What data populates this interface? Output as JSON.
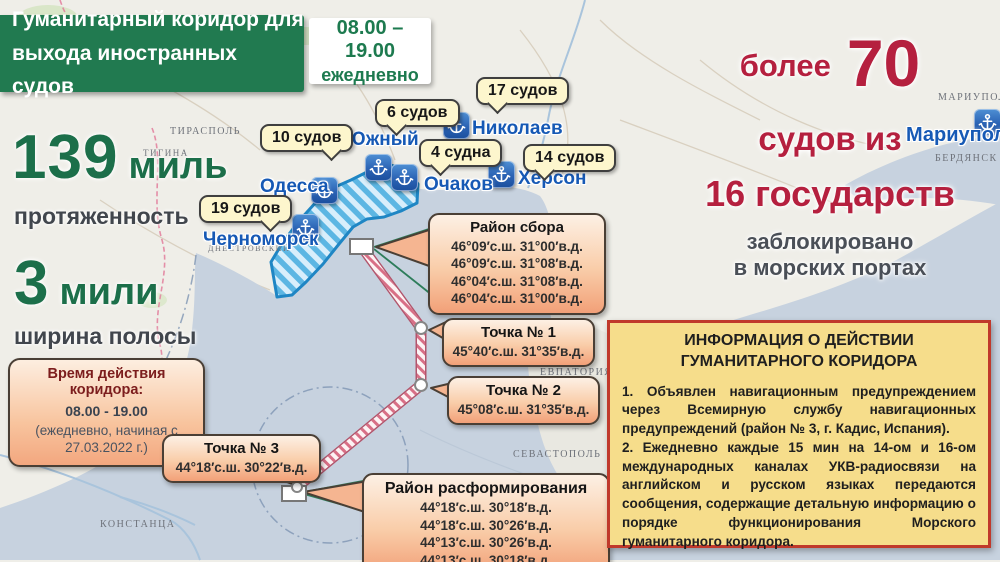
{
  "header": {
    "title": "Гуманитарный коридор для выхода иностранных судов",
    "schedule_time": "08.00 – 19.00",
    "schedule_note": "ежедневно"
  },
  "stats": {
    "length_value": "139",
    "length_unit": "миль",
    "length_label": "протяженность",
    "width_value": "3",
    "width_unit": "мили",
    "width_label": "ширина полосы"
  },
  "corridor_time_box": {
    "title": "Время действия коридора:",
    "time": "08.00 - 19.00",
    "note": "(ежедневно, начиная с 27.03.2022 г.)"
  },
  "blocked_summary": {
    "word_more": "более",
    "count": "70",
    "line2": "судов из",
    "line3": "16 государств",
    "line4": "заблокировано",
    "line5": "в морских портах"
  },
  "ports": [
    {
      "name": "Черноморск",
      "ships": "19 судов"
    },
    {
      "name": "Одесса",
      "ships": "10 судов"
    },
    {
      "name": "Южный",
      "ships": "6 судов"
    },
    {
      "name": "Очаков",
      "ships": "4 судна"
    },
    {
      "name": "Николаев",
      "ships": "17 судов"
    },
    {
      "name": "Херсон",
      "ships": "14 судов"
    },
    {
      "name": "Мариуполь",
      "ships": ""
    }
  ],
  "callouts": [
    {
      "title": "Район сбора",
      "lines": [
        "46°09′с.ш.  31°00′в.д.",
        "46°09′с.ш.  31°08′в.д.",
        "46°04′с.ш.  31°08′в.д.",
        "46°04′с.ш.  31°00′в.д."
      ]
    },
    {
      "title": "Точка № 1",
      "lines": [
        "45°40′с.ш.  31°35′в.д."
      ]
    },
    {
      "title": "Точка № 2",
      "lines": [
        "45°08′с.ш.  31°35′в.д."
      ]
    },
    {
      "title": "Точка № 3",
      "lines": [
        "44°18′с.ш.  30°22′в.д."
      ]
    },
    {
      "title": "Район расформирования",
      "lines": [
        "44°18′с.ш.  30°18′в.д.",
        "44°18′с.ш.  30°26′в.д.",
        "44°13′с.ш.  30°26′в.д.",
        "44°13′с.ш.  30°18′в.д."
      ]
    }
  ],
  "info_box": {
    "title_line1": "ИНФОРМАЦИЯ О ДЕЙСТВИИ",
    "title_line2": "ГУМАНИТАРНОГО КОРИДОРА",
    "item1": "1. Объявлен навигационным предупреждением через Всемирную службу навигационных предупреждений (район № 3, г. Кадис, Испания).",
    "item2": "2. Ежедневно каждые 15 мин на 14-ом и 16-ом международных каналах УКВ-радиосвязи на английском и русском языках передаются сообщения, содержащие детальную информацию о порядке функционирования Морского гуманитарного коридора."
  },
  "map_labels": [
    "ТИРАСПОЛЬ",
    "ТИГИНА",
    "ЕВПАТОРИЯ",
    "СЕВАСТОПОЛЬ",
    "МАРИУПОЛЬ",
    "БЕРДЯНСК",
    "КОНСТАНЦА",
    "ДНЕСТРОВСКИЙ"
  ],
  "icons": {
    "anchor_glyph": "⚓"
  },
  "colors": {
    "green": "#217a50",
    "red": "#b5203f",
    "sea": "#c7d2df",
    "corridor_blue": "#1f86c4",
    "callout_border": "#4a3f35",
    "info_bg": "#f6dd8b",
    "info_border": "#c0392b"
  }
}
